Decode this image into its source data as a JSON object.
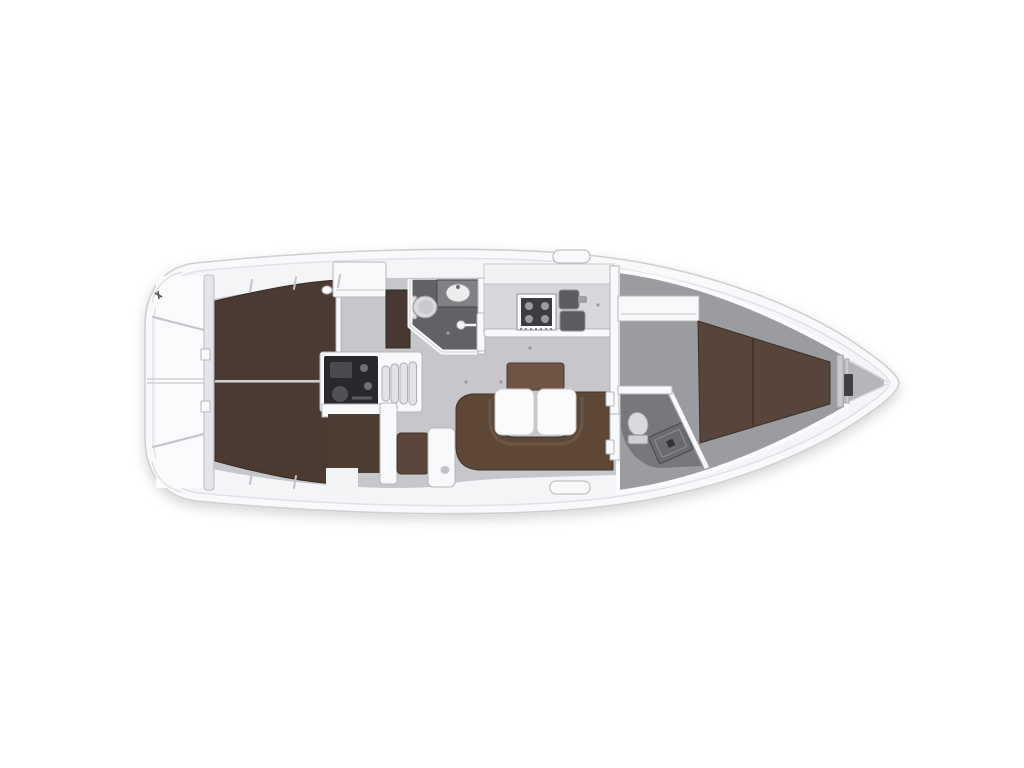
{
  "page": {
    "background_color": "#ffffff"
  },
  "boat_plan": {
    "kind": "sailing-yacht-interior-floor-plan-top-view",
    "orientation": {
      "bow": "right",
      "stern": "left"
    },
    "regions": [
      "stern-deck",
      "aft-double-berth",
      "engine-compartment",
      "companionway-steps",
      "aft-heads-bathroom",
      "galley",
      "salon-dinette",
      "chart-seat-nook",
      "forward-heads-bathroom",
      "forward-cabin-berth",
      "anchor-locker"
    ],
    "colors": {
      "hull": "#f8f9fa",
      "deck": "#f4f5f7",
      "floor_salon": "#c6c7cb",
      "floor_forward_cabin": "#9b9ca0",
      "floor_aft_heads": "#616266",
      "floor_forward_heads": "#77787c",
      "berth_aft": "#4a3a31",
      "berth_forward": "#57443a",
      "sofa": "#5d4737",
      "sofa_cushion": "#6e5546",
      "seat_small": "#5a463a",
      "aft_cabin_access": "#4e3d33",
      "cabinet_brown": "#473831",
      "galley_counter": "#d7d8db",
      "stove_dark": "#3c3d41",
      "sink_dark": "#5b5c60",
      "engine": "#28292c",
      "engine_detail": "#4a4b50",
      "steps": "#e2e3e5",
      "table": "#fbfbfc",
      "fixture_light": "#d8d9db",
      "accent_pillow": "#5c3a33",
      "windlass": "#3f4044",
      "bulkhead_bar": "#e4e5e8",
      "bow_wedge": "#b5b6ba"
    }
  }
}
